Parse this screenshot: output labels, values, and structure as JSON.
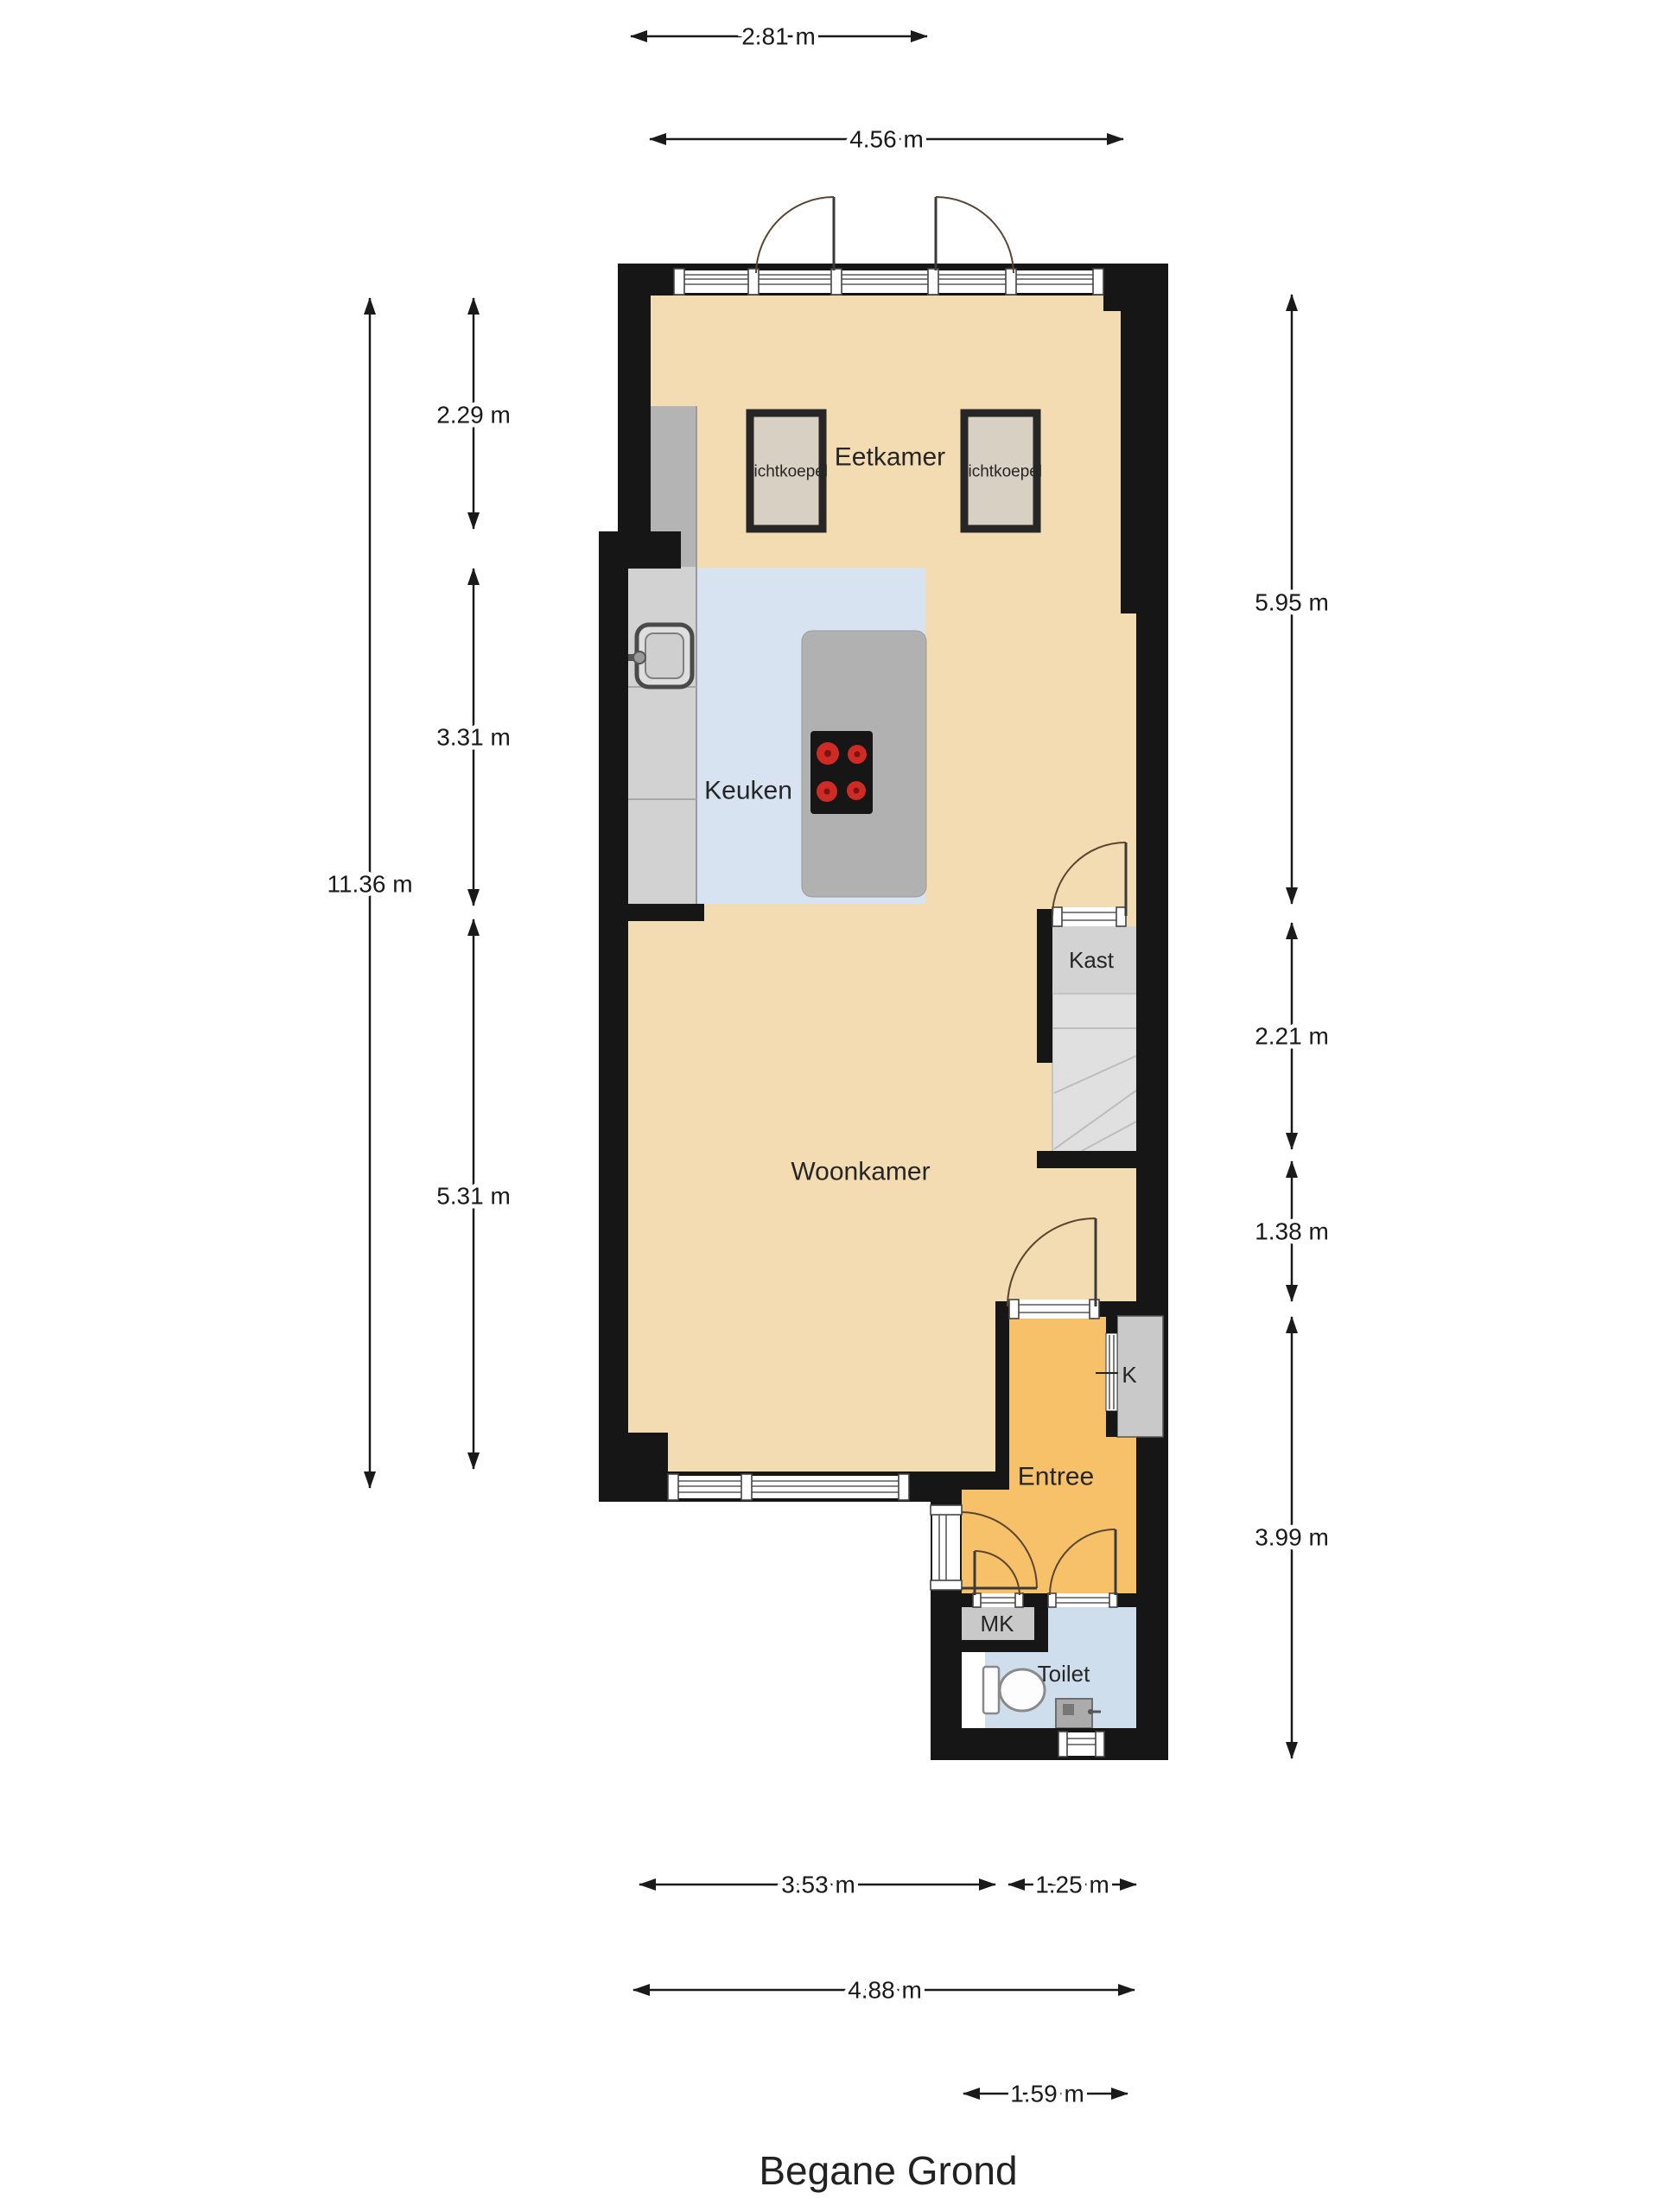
{
  "title": "Begane Grond",
  "rooms": {
    "eetkamer": "Eetkamer",
    "keuken": "Keuken",
    "woonkamer": "Woonkamer",
    "entree": "Entree",
    "toilet": "Toilet",
    "kast": "Kast",
    "meterkast": "MK",
    "k": "K",
    "lichtkoepel": "Lichtkoepel"
  },
  "dimensions": {
    "top_partial": "2.81 m",
    "top_full": "4.56 m",
    "left_full": "11.36 m",
    "left_seg1": "2.29 m",
    "left_seg2": "3.31 m",
    "left_seg3": "5.31 m",
    "right_seg1": "5.95 m",
    "right_seg2": "2.21 m",
    "right_seg3": "1.38 m",
    "right_seg4": "3.99 m",
    "bottom_seg1": "3.53 m",
    "bottom_seg2": "1.25 m",
    "bottom_full": "4.88 m",
    "bottom_extension": "1.59 m"
  },
  "colors": {
    "wall": "#161616",
    "floor_main": "#f3dcb1",
    "floor_kitchen": "#d7e3f1",
    "floor_entree": "#f6c169",
    "floor_toilet": "#cfdeed",
    "burner_red": "#cf2b24"
  }
}
